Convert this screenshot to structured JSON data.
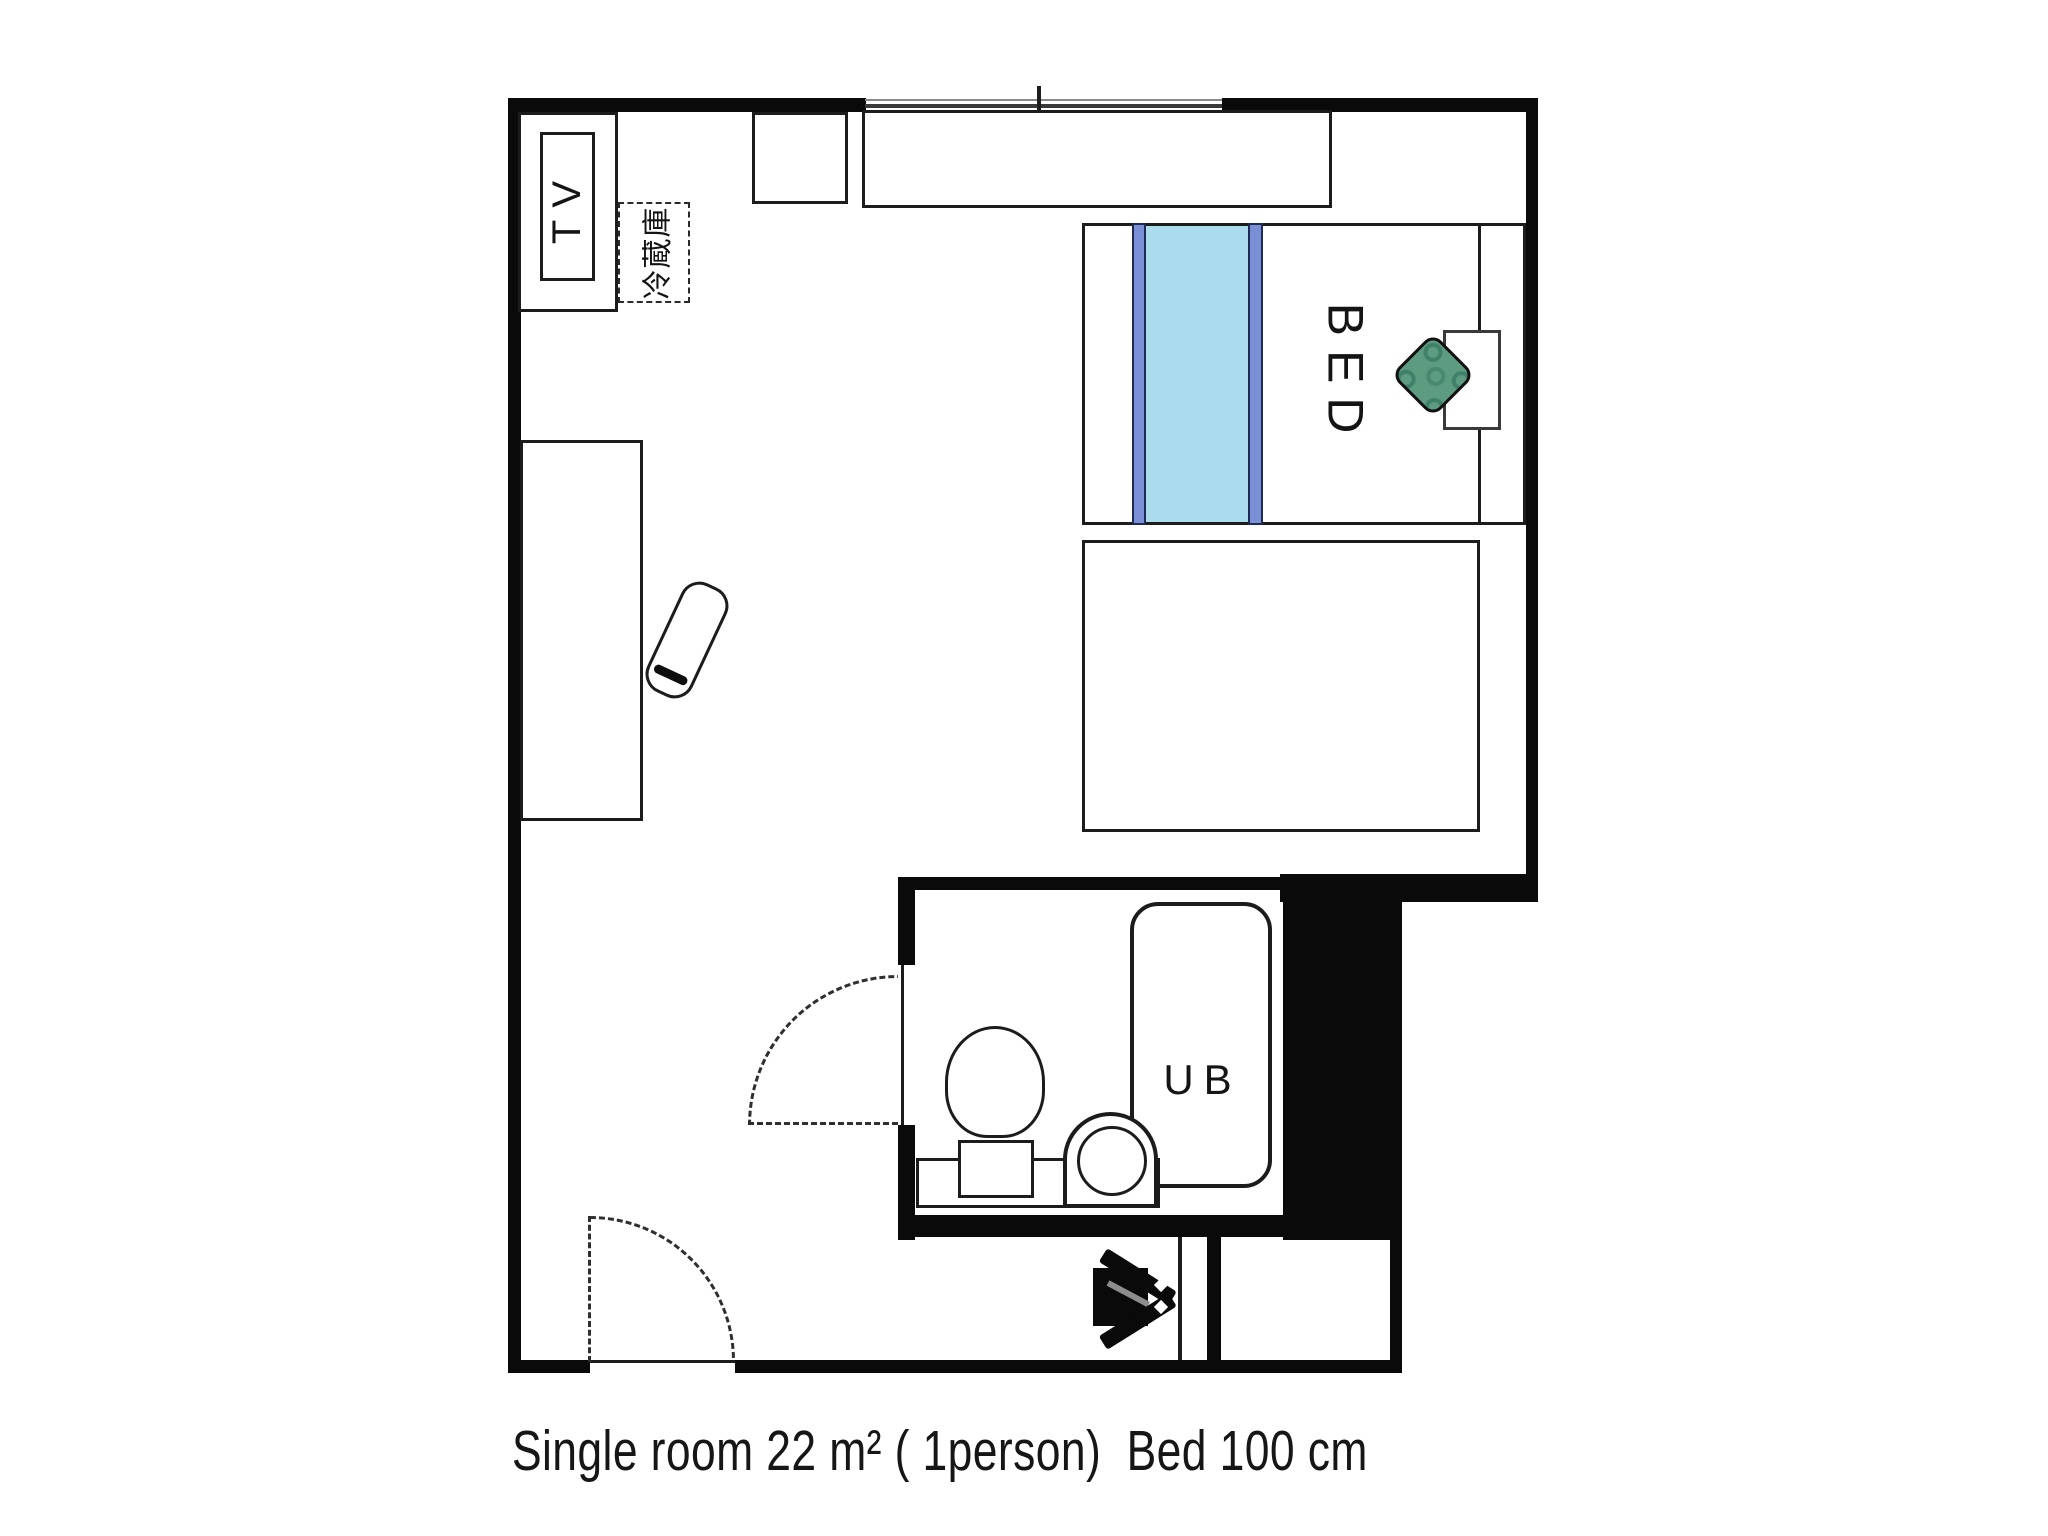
{
  "caption": "Single room 22 m² ( 1person)  Bed 100 cm",
  "labels": {
    "tv": "TV",
    "refrigerator": "冷蔵庫",
    "bed": "BED",
    "unit_bath": "UB"
  },
  "colors": {
    "background": "#ffffff",
    "wall_black": "#0a0a0a",
    "line_dark": "#1c1c1c",
    "bed_runner_light_blue": "#aadcee",
    "bed_runner_dark_blue": "#7b8fd6",
    "cushion_green": "#5e9c82",
    "cushion_pattern_green": "#3f8168",
    "window_line_gray": "#555555"
  },
  "fixtures": [
    "tv-cabinet",
    "refrigerator-dashed-box",
    "wall-closet-small",
    "wall-shelf-long",
    "window",
    "desk",
    "desk-chair",
    "bed",
    "bed-runner",
    "pillow",
    "green-cushion",
    "bed-lower-section",
    "bathroom",
    "bathtub",
    "toilet",
    "sink-counter",
    "sink-bowl",
    "bathroom-door-swing",
    "entrance-door-swing",
    "entrance-arrow-symbol",
    "shoe-closet-nook"
  ]
}
